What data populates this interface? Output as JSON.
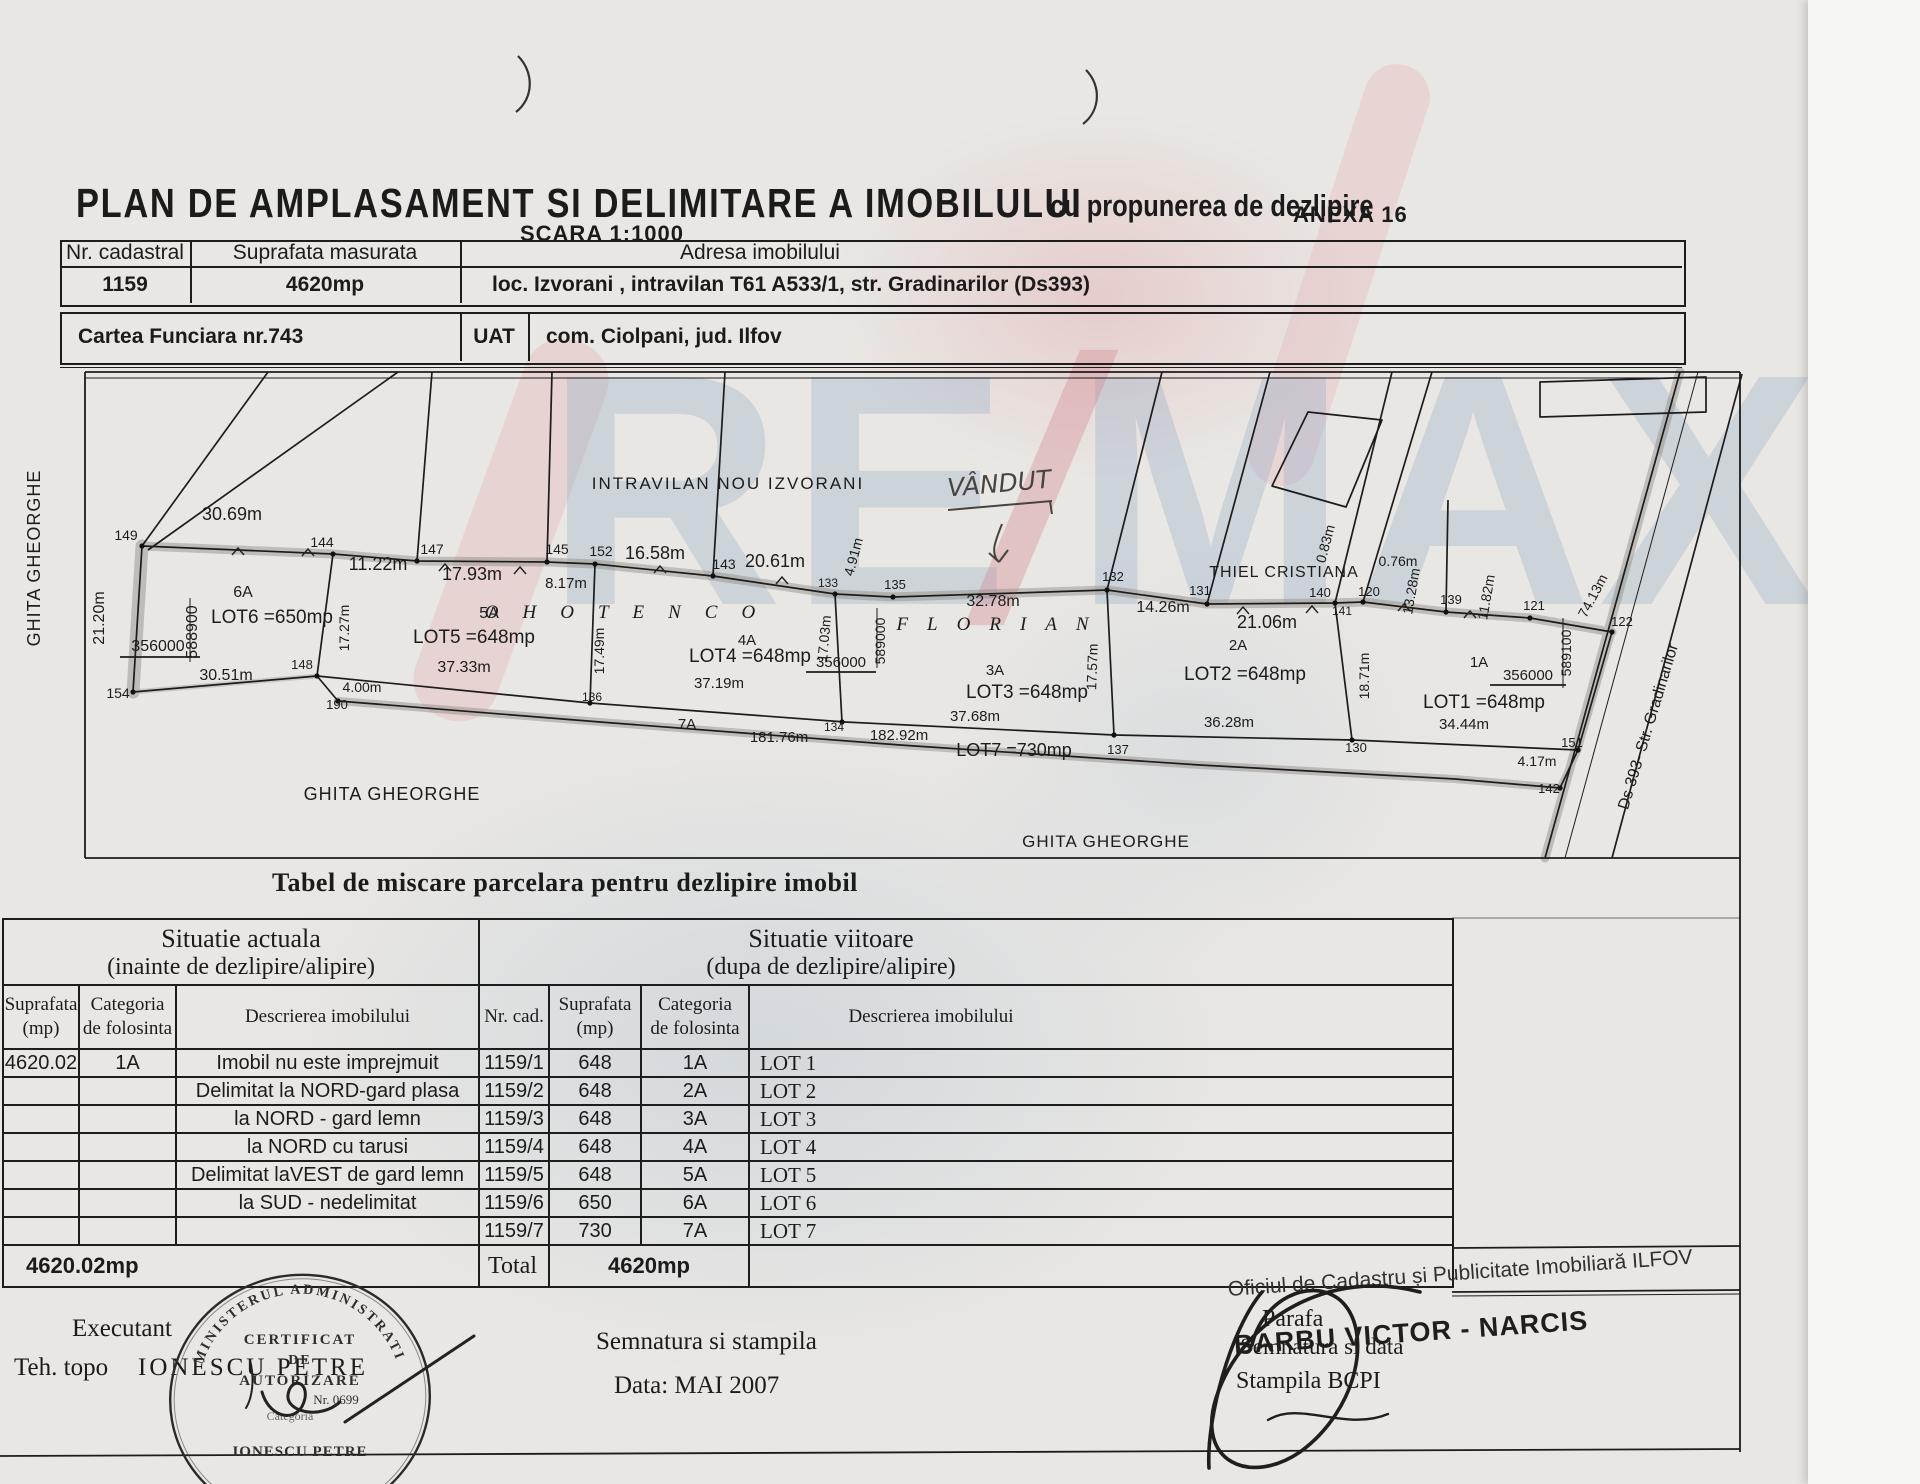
{
  "page": {
    "title": "PLAN DE AMPLASAMENT SI DELIMITARE A IMOBILULUI",
    "subtitle": "cu propunerea de dezlipire",
    "anexa": "ANEXA 16",
    "scale": "SCARA 1:1000"
  },
  "header_table": {
    "nr_cadastral_label": "Nr. cadastral",
    "nr_cadastral": "1159",
    "suprafata_label": "Suprafata masurata",
    "suprafata": "4620mp",
    "adresa_label": "Adresa imobilului",
    "adresa": "loc. Izvorani , intravilan T61 A533/1, str. Gradinarilor (Ds393)"
  },
  "cf_table": {
    "cartea_funciara": "Cartea Funciara nr.743",
    "uat_label": "UAT",
    "uat": "com. Ciolpani, jud. Ilfov"
  },
  "watermark": {
    "re": "RE",
    "slash": "/",
    "max": "MAX"
  },
  "plan": {
    "labels": [
      {
        "t": "GHITA GHEORGHE",
        "x": 40,
        "y": 558,
        "r": -90,
        "s": 18,
        "ls": 1
      },
      {
        "t": "21.20m",
        "x": 104,
        "y": 618,
        "r": -90,
        "s": 16
      },
      {
        "t": "30.69m",
        "x": 232,
        "y": 520,
        "s": 18
      },
      {
        "t": "149",
        "x": 126,
        "y": 540,
        "s": 14
      },
      {
        "t": "144",
        "x": 322,
        "y": 547,
        "s": 14
      },
      {
        "t": "11.22m",
        "x": 378,
        "y": 570,
        "s": 18
      },
      {
        "t": "147",
        "x": 432,
        "y": 554,
        "s": 14
      },
      {
        "t": "17.93m",
        "x": 472,
        "y": 580,
        "s": 18
      },
      {
        "t": "145",
        "x": 557,
        "y": 554,
        "s": 14
      },
      {
        "t": "8.17m",
        "x": 566,
        "y": 588,
        "s": 15
      },
      {
        "t": "152",
        "x": 601,
        "y": 556,
        "s": 14
      },
      {
        "t": "16.58m",
        "x": 655,
        "y": 559,
        "s": 18
      },
      {
        "t": "143",
        "x": 724,
        "y": 569,
        "s": 14
      },
      {
        "t": "20.61m",
        "x": 775,
        "y": 567,
        "s": 18
      },
      {
        "t": "4.91m",
        "x": 858,
        "y": 558,
        "r": -75,
        "s": 14
      },
      {
        "t": "133",
        "x": 828,
        "y": 587,
        "s": 12
      },
      {
        "t": "135",
        "x": 895,
        "y": 589,
        "s": 13
      },
      {
        "t": "INTRAVILAN  NOU  IZVORANI",
        "x": 728,
        "y": 489,
        "s": 17,
        "ls": 2
      },
      {
        "t": "VÂNDUT",
        "x": 1000,
        "y": 492,
        "r": -5,
        "s": 25,
        "cls": "hand"
      },
      {
        "t": "OHOTENCO",
        "x": 632,
        "y": 618,
        "s": 19,
        "ls": 24,
        "cls": "own"
      },
      {
        "t": "FLORIAN",
        "x": 1002,
        "y": 630,
        "s": 19,
        "ls": 19,
        "cls": "own"
      },
      {
        "t": "32.78m",
        "x": 993,
        "y": 606,
        "s": 16
      },
      {
        "t": "132",
        "x": 1113,
        "y": 581,
        "s": 13
      },
      {
        "t": "14.26m",
        "x": 1163,
        "y": 612,
        "s": 16
      },
      {
        "t": "131",
        "x": 1200,
        "y": 595,
        "s": 13
      },
      {
        "t": "21.06m",
        "x": 1267,
        "y": 628,
        "s": 18
      },
      {
        "t": "THIEL CRISTIANA",
        "x": 1284,
        "y": 577,
        "s": 16,
        "ls": 1
      },
      {
        "t": "0.83m",
        "x": 1330,
        "y": 545,
        "r": -75,
        "s": 14
      },
      {
        "t": "140",
        "x": 1320,
        "y": 597,
        "s": 13
      },
      {
        "t": "120",
        "x": 1369,
        "y": 596,
        "s": 13
      },
      {
        "t": "141",
        "x": 1342,
        "y": 615,
        "s": 12
      },
      {
        "t": "0.76m",
        "x": 1398,
        "y": 566,
        "s": 14
      },
      {
        "t": "13.28m",
        "x": 1416,
        "y": 592,
        "r": -80,
        "s": 14
      },
      {
        "t": "139",
        "x": 1451,
        "y": 604,
        "s": 13
      },
      {
        "t": "11.82m",
        "x": 1491,
        "y": 598,
        "r": -80,
        "s": 14
      },
      {
        "t": "121",
        "x": 1534,
        "y": 610,
        "s": 13
      },
      {
        "t": "74.13m",
        "x": 1597,
        "y": 598,
        "r": -62,
        "s": 14
      },
      {
        "t": "122",
        "x": 1622,
        "y": 626,
        "s": 13
      },
      {
        "t": "6A",
        "x": 243,
        "y": 597,
        "s": 16
      },
      {
        "t": "LOT6  =650mp",
        "x": 272,
        "y": 623,
        "s": 19
      },
      {
        "t": "588900",
        "x": 197,
        "y": 632,
        "r": -90,
        "s": 16
      },
      {
        "t": "356000",
        "x": 158,
        "y": 651,
        "s": 16
      },
      {
        "t": "30.51m",
        "x": 226,
        "y": 680,
        "s": 16
      },
      {
        "t": "154",
        "x": 118,
        "y": 698,
        "s": 14
      },
      {
        "t": "17.27m",
        "x": 349,
        "y": 628,
        "r": -90,
        "s": 14
      },
      {
        "t": "5A",
        "x": 489,
        "y": 618,
        "s": 16
      },
      {
        "t": "LOT5  =648mp",
        "x": 474,
        "y": 643,
        "s": 19
      },
      {
        "t": "37.33m",
        "x": 464,
        "y": 672,
        "s": 16
      },
      {
        "t": "148",
        "x": 302,
        "y": 669,
        "s": 13
      },
      {
        "t": "4.00m",
        "x": 362,
        "y": 692,
        "s": 14
      },
      {
        "t": "190",
        "x": 337,
        "y": 709,
        "s": 13
      },
      {
        "t": "17.49m",
        "x": 604,
        "y": 651,
        "r": -90,
        "s": 14
      },
      {
        "t": "4A",
        "x": 747,
        "y": 645,
        "s": 15
      },
      {
        "t": "LOT4  =648mp",
        "x": 750,
        "y": 662,
        "s": 19
      },
      {
        "t": "356000",
        "x": 841,
        "y": 667,
        "s": 15
      },
      {
        "t": "589000",
        "x": 885,
        "y": 641,
        "r": -90,
        "s": 14
      },
      {
        "t": "37.19m",
        "x": 719,
        "y": 688,
        "s": 15
      },
      {
        "t": "136",
        "x": 592,
        "y": 701,
        "s": 12
      },
      {
        "t": "17.03m",
        "x": 829,
        "y": 639,
        "r": -85,
        "s": 14
      },
      {
        "t": "3A",
        "x": 995,
        "y": 675,
        "s": 15
      },
      {
        "t": "LOT3  =648mp",
        "x": 1027,
        "y": 698,
        "s": 19
      },
      {
        "t": "37.68m",
        "x": 975,
        "y": 721,
        "s": 15
      },
      {
        "t": "17.57m",
        "x": 1097,
        "y": 667,
        "r": -88,
        "s": 14
      },
      {
        "t": "134",
        "x": 834,
        "y": 731,
        "s": 12
      },
      {
        "t": "182.92m",
        "x": 899,
        "y": 740,
        "s": 15
      },
      {
        "t": "2A",
        "x": 1238,
        "y": 650,
        "s": 15
      },
      {
        "t": "LOT2  =648mp",
        "x": 1245,
        "y": 680,
        "s": 19
      },
      {
        "t": "36.28m",
        "x": 1229,
        "y": 727,
        "s": 15
      },
      {
        "t": "18.71m",
        "x": 1369,
        "y": 676,
        "r": -90,
        "s": 14
      },
      {
        "t": "1A",
        "x": 1479,
        "y": 667,
        "s": 15
      },
      {
        "t": "356000",
        "x": 1528,
        "y": 680,
        "s": 15
      },
      {
        "t": "589100",
        "x": 1571,
        "y": 653,
        "r": -90,
        "s": 14
      },
      {
        "t": "LOT1  =648mp",
        "x": 1484,
        "y": 708,
        "s": 19
      },
      {
        "t": "34.44m",
        "x": 1464,
        "y": 729,
        "s": 15
      },
      {
        "t": "130",
        "x": 1356,
        "y": 752,
        "s": 13
      },
      {
        "t": "7A",
        "x": 687,
        "y": 729,
        "s": 15
      },
      {
        "t": "181.76m",
        "x": 779,
        "y": 742,
        "s": 15
      },
      {
        "t": "LOT7  =730mp",
        "x": 1014,
        "y": 756,
        "s": 18
      },
      {
        "t": "137",
        "x": 1118,
        "y": 754,
        "s": 13
      },
      {
        "t": "151",
        "x": 1572,
        "y": 747,
        "s": 13
      },
      {
        "t": "4.17m",
        "x": 1537,
        "y": 766,
        "s": 14
      },
      {
        "t": "142",
        "x": 1549,
        "y": 793,
        "s": 13
      },
      {
        "t": "GHITA GHEORGHE",
        "x": 392,
        "y": 800,
        "s": 18,
        "ls": 1
      },
      {
        "t": "GHITA GHEORGHE",
        "x": 1106,
        "y": 847,
        "s": 17,
        "ls": 1
      },
      {
        "t": "Ds 393-  Str. Gradinarilor",
        "x": 1653,
        "y": 728,
        "r": -73,
        "s": 16
      }
    ]
  },
  "parcel_table": {
    "title": "Tabel de miscare parcelara pentru dezlipire imobil",
    "group_current": {
      "l1": "Situatie actuala",
      "l2": "(inainte de dezlipire/alipire)"
    },
    "group_future": {
      "l1": "Situatie viitoare",
      "l2": "(dupa de dezlipire/alipire)"
    },
    "columns": {
      "sup": {
        "l1": "Suprafata",
        "l2": "(mp)"
      },
      "cat": {
        "l1": "Categoria",
        "l2": "de folosinta"
      },
      "desc": {
        "l1": "Descrierea imobilului",
        "l2": ""
      },
      "nr": {
        "l1": "Nr. cad.",
        "l2": ""
      },
      "sup2": {
        "l1": "Suprafata",
        "l2": "(mp)"
      },
      "cat2": {
        "l1": "Categoria",
        "l2": "de folosinta"
      },
      "desc2": {
        "l1": "Descrierea imobilului",
        "l2": ""
      }
    },
    "rows": [
      {
        "sup": "4620.02",
        "cat": "1A",
        "desc": "Imobil nu este  imprejmuit",
        "nr": "1159/1",
        "sup2": "648",
        "cat2": "1A",
        "lot": "LOT 1"
      },
      {
        "sup": "",
        "cat": "",
        "desc": "Delimitat la NORD-gard plasa",
        "nr": "1159/2",
        "sup2": "648",
        "cat2": "2A",
        "lot": "LOT 2"
      },
      {
        "sup": "",
        "cat": "",
        "desc": "la NORD - gard lemn",
        "nr": "1159/3",
        "sup2": "648",
        "cat2": "3A",
        "lot": "LOT 3"
      },
      {
        "sup": "",
        "cat": "",
        "desc": "la NORD cu tarusi",
        "nr": "1159/4",
        "sup2": "648",
        "cat2": "4A",
        "lot": "LOT 4"
      },
      {
        "sup": "",
        "cat": "",
        "desc": "Delimitat laVEST de gard lemn",
        "nr": "1159/5",
        "sup2": "648",
        "cat2": "5A",
        "lot": "LOT 5"
      },
      {
        "sup": "",
        "cat": "",
        "desc": "la SUD - nedelimitat",
        "nr": "1159/6",
        "sup2": "650",
        "cat2": "6A",
        "lot": "LOT 6"
      },
      {
        "sup": "",
        "cat": "",
        "desc": "",
        "nr": "1159/7",
        "sup2": "730",
        "cat2": "7A",
        "lot": "LOT 7"
      }
    ],
    "total": {
      "sup": "4620.02mp",
      "label": "Total",
      "value": "4620mp"
    }
  },
  "stamp": {
    "ring": "MINISTERUL  ADMINISTRATIEI  PUBLICE",
    "l1": "CERTIFICAT",
    "l2": "DE",
    "l3": "AUTORIZARE",
    "l4": "Nr. 0699",
    "l5": "Categoria",
    "name": "IONESCU PETRE"
  },
  "footer": {
    "executant_label": "Executant",
    "teh_topo": "Teh. topo",
    "executant_name": "IONESCU PETRE",
    "semnatura_stampila": "Semnatura si stampila",
    "data": "Data: MAI  2007",
    "oficiu": "Oficiul de Cadastru și Publicitate Imobiliară ILFOV",
    "parafa": "Parafa",
    "semnatura_data": "Semnatura si data",
    "stampila_bcpi": "Stampila BCPI",
    "inspector": "BARBU VICTOR - NARCIS"
  }
}
